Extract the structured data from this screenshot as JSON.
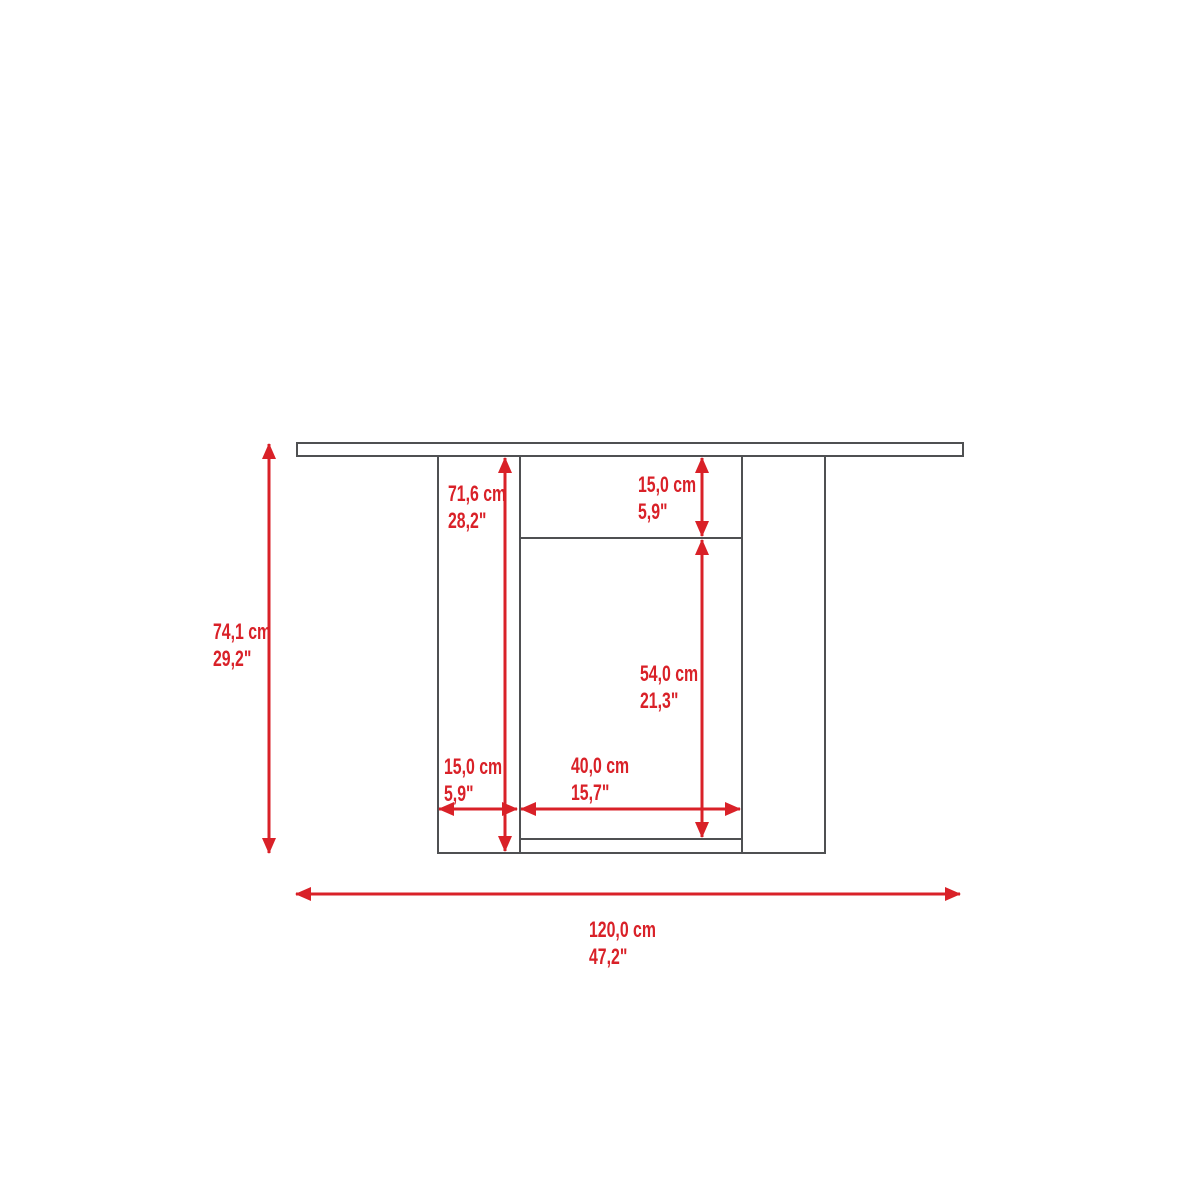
{
  "diagram": {
    "type": "furniture-dimension-drawing",
    "view": "front-elevation",
    "units": [
      "cm",
      "inch"
    ],
    "colors": {
      "dimension_red": "#d92128",
      "outline_gray": "#4f5052",
      "background": "#ffffff"
    },
    "labels": {
      "overall_height": {
        "cm": "74,1 cm",
        "inch": "29,2\""
      },
      "panel_height": {
        "cm": "71,6 cm",
        "inch": "28,2\""
      },
      "apron_height": {
        "cm": "15,0 cm",
        "inch": "5,9\""
      },
      "opening_height": {
        "cm": "54,0 cm",
        "inch": "21,3\""
      },
      "side_panel_width": {
        "cm": "15,0 cm",
        "inch": "5,9\""
      },
      "opening_width": {
        "cm": "40,0 cm",
        "inch": "15,7\""
      },
      "overall_width": {
        "cm": "120,0 cm",
        "inch": "47,2\""
      }
    }
  }
}
